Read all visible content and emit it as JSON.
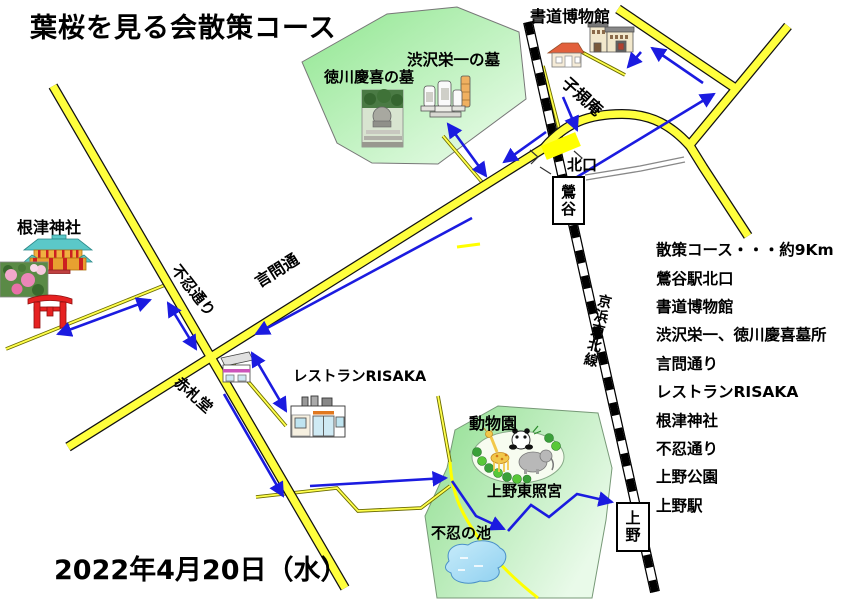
{
  "title": "葉桜を見る会散策コース",
  "date": "2022年4月20日（水）",
  "course_list": {
    "items": [
      "散策コース・・・約9Km",
      "鶯谷駅北口",
      "書道博物館",
      "渋沢栄一、徳川慶喜墓所",
      "言問通り",
      "レストランRISAKA",
      "根津神社",
      "不忍通り",
      "上野公園",
      "上野駅"
    ]
  },
  "stations": {
    "uguisudani": "鶯谷",
    "ueno": "上野",
    "north_exit": "北口",
    "line_name": "京浜東北線"
  },
  "roads": {
    "kototoi": "言問通",
    "shinobazu": "不忍通り"
  },
  "places": {
    "shodo_museum": "書道博物館",
    "shikian": "子規庵",
    "shibusawa_grave": "渋沢栄一の墓",
    "tokugawa_grave": "徳川慶喜の墓",
    "nezu_shrine": "根津神社",
    "akafudado": "赤札堂",
    "restaurant_risaka": "レストランRISAKA",
    "zoo": "動物園",
    "ueno_toshogu": "上野東照宮",
    "shinobazu_pond": "不忍の池"
  },
  "colors": {
    "road_yellow": "#ffff3d",
    "road_casing": "#111111",
    "thin_road_casing": "#6b6b00",
    "route_arrow_blue": "#1b1be0",
    "park_green": "#9de89d",
    "rail_black": "#000000",
    "pond_blue": "#a8d8f0",
    "crossing_yellow": "#ffff00"
  }
}
